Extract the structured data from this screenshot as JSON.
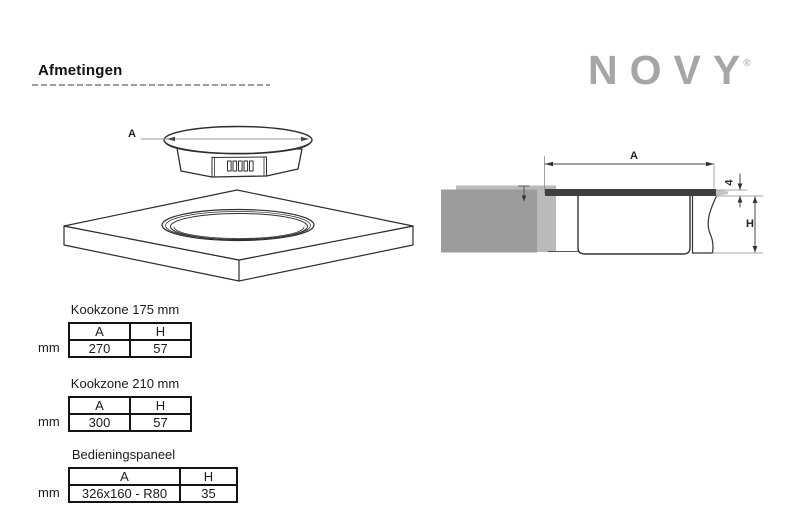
{
  "page": {
    "title": "Afmetingen"
  },
  "brand": {
    "name": "NOVY",
    "registered": "®"
  },
  "drawings": {
    "isometric": {
      "dim_a": "A"
    },
    "section": {
      "dim_a": "A",
      "dim_h": "H",
      "dim_thickness": "4"
    }
  },
  "tables": [
    {
      "title": "Kookzone 175 mm",
      "unit": "mm",
      "headers": [
        "A",
        "H"
      ],
      "values": [
        "270",
        "57"
      ]
    },
    {
      "title": "Kookzone 210 mm",
      "unit": "mm",
      "headers": [
        "A",
        "H"
      ],
      "values": [
        "300",
        "57"
      ]
    },
    {
      "title": "Bedieningspaneel",
      "unit": "mm",
      "headers": [
        "A",
        "H"
      ],
      "values": [
        "326x160 - R80",
        "35"
      ]
    }
  ],
  "colors": {
    "logo_gray": "#a6a6a6",
    "worktop_gray": "#9c9c9c",
    "worktop_light_gray": "#bababa",
    "glass_dark": "#3f3f3f",
    "line_dark": "#2e2e2e"
  }
}
